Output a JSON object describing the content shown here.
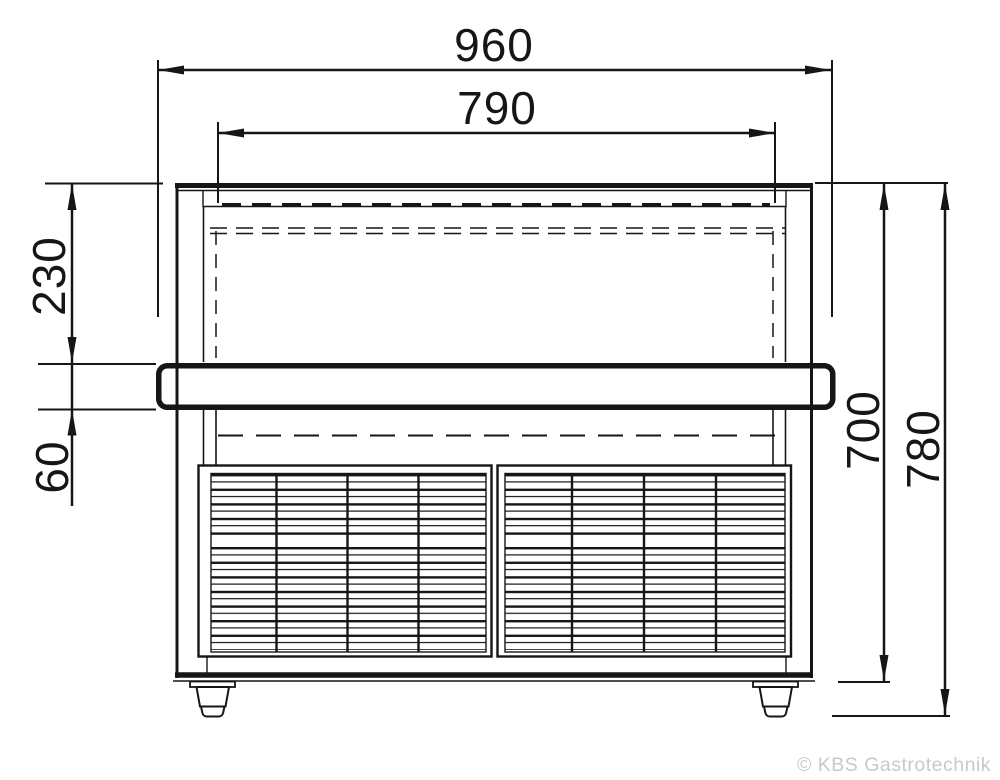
{
  "dimensions": {
    "overall_width": "960",
    "inner_width": "790",
    "top_to_bumper_height": "230",
    "bumper_height": "60",
    "body_height": "700",
    "overall_height": "780"
  },
  "watermark": {
    "text": "© KBS Gastrotechnik"
  },
  "colors": {
    "line": "#161616",
    "watermark": "#c9c9c9",
    "background": "#ffffff"
  }
}
